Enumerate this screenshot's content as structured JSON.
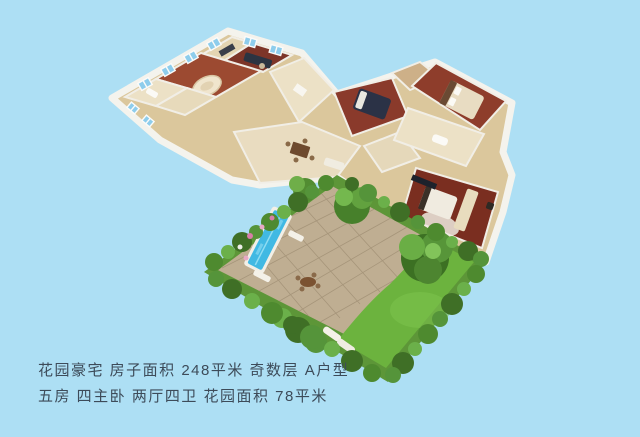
{
  "caption": {
    "line1": "花园豪宅 房子面积 248平米 奇数层 A户型",
    "line2": "五房 四主卧 两厅四卫 花园面积 78平米"
  },
  "property": {
    "title": "花园豪宅",
    "house_area": "248平米",
    "floor_parity": "奇数层",
    "unit_type": "A户型",
    "rooms": "五房",
    "master_bedrooms": "四主卧",
    "halls_baths": "两厅四卫",
    "garden_area": "78平米"
  },
  "palette": {
    "background": "#addff4",
    "outer_wall_white": "#f4f3ed",
    "inner_wall_tan": "#dbc79c",
    "wood_floor_dark": "#7a2e20",
    "wood_floor": "#8e3d2b",
    "wood_floor_light": "#9c4a31",
    "cream_tile": "#ece1c6",
    "dining_tile": "#e9dcc0",
    "patio_stone": "#bfae92",
    "lawn_green": "#6cb33e",
    "foliage_green": "#4e8a2f",
    "pool_water": "#41b9e3",
    "caption_text": "#3d4b59"
  }
}
